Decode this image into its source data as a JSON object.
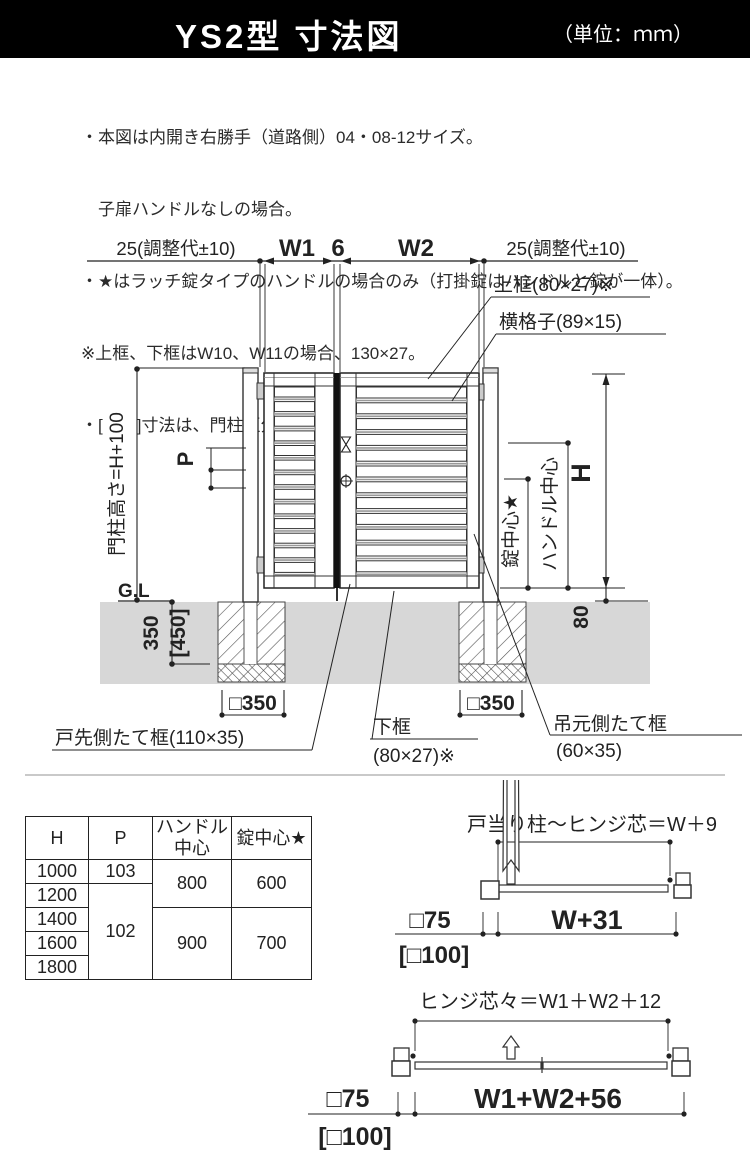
{
  "header": {
    "title": "YS2型 寸法図",
    "unit": "（単位：ｍｍ）",
    "bg": "#000000",
    "fg": "#ffffff"
  },
  "notes": {
    "line1": "・本図は内開き右勝手（道路側）04・08-12サイズ。",
    "line2": "　子扉ハンドルなしの場合。",
    "line3": "・★はラッチ錠タイプのハンドルの場合のみ（打掛錠はハンドルと錠が一体）。",
    "line4": "※上框、下框はW10、W11の場合、130×27。",
    "line5": "・[　　]寸法は、門柱区分100角の場合。"
  },
  "drawing": {
    "dim_adjust": "25(調整代±10)",
    "dim_w1": "W1",
    "dim_gap6": "6",
    "dim_w2": "W2",
    "label_top_rail": "上框(80×27)※",
    "label_crossbar": "横格子(89×15)",
    "label_post_height": "門柱高さ=H+100",
    "label_p": "P",
    "label_gl": "G.L",
    "dim_350": "350",
    "dim_450": "[450]",
    "dim_sq350": "□350",
    "label_lock_center": "錠中心★",
    "label_handle_center": "ハンドル中心",
    "label_h": "H",
    "dim_80": "80",
    "label_latch_stile": "戸先側たて框(110×35)",
    "label_bottom_rail": "下框",
    "label_bottom_rail_size": "(80×27)※",
    "label_hinge_stile": "吊元側たて框",
    "label_hinge_stile_size": "(60×35)",
    "ground_color": "#d7d7d7"
  },
  "table": {
    "headers": [
      "H",
      "P",
      "ハンドル中心",
      "錠中心★"
    ],
    "h": [
      "1000",
      "1200",
      "1400",
      "1600",
      "1800"
    ],
    "p": [
      "103",
      "102"
    ],
    "handle": [
      "800",
      "900"
    ],
    "lock": [
      "600",
      "700"
    ]
  },
  "plan_top": {
    "title": "戸当り柱～ヒンジ芯＝W＋9",
    "dim": "W+31",
    "post": "□75",
    "post_alt": "[□100]"
  },
  "plan_bottom": {
    "title": "ヒンジ芯々＝W1＋W2＋12",
    "dim": "W1+W2+56",
    "post": "□75",
    "post_alt": "[□100]"
  }
}
